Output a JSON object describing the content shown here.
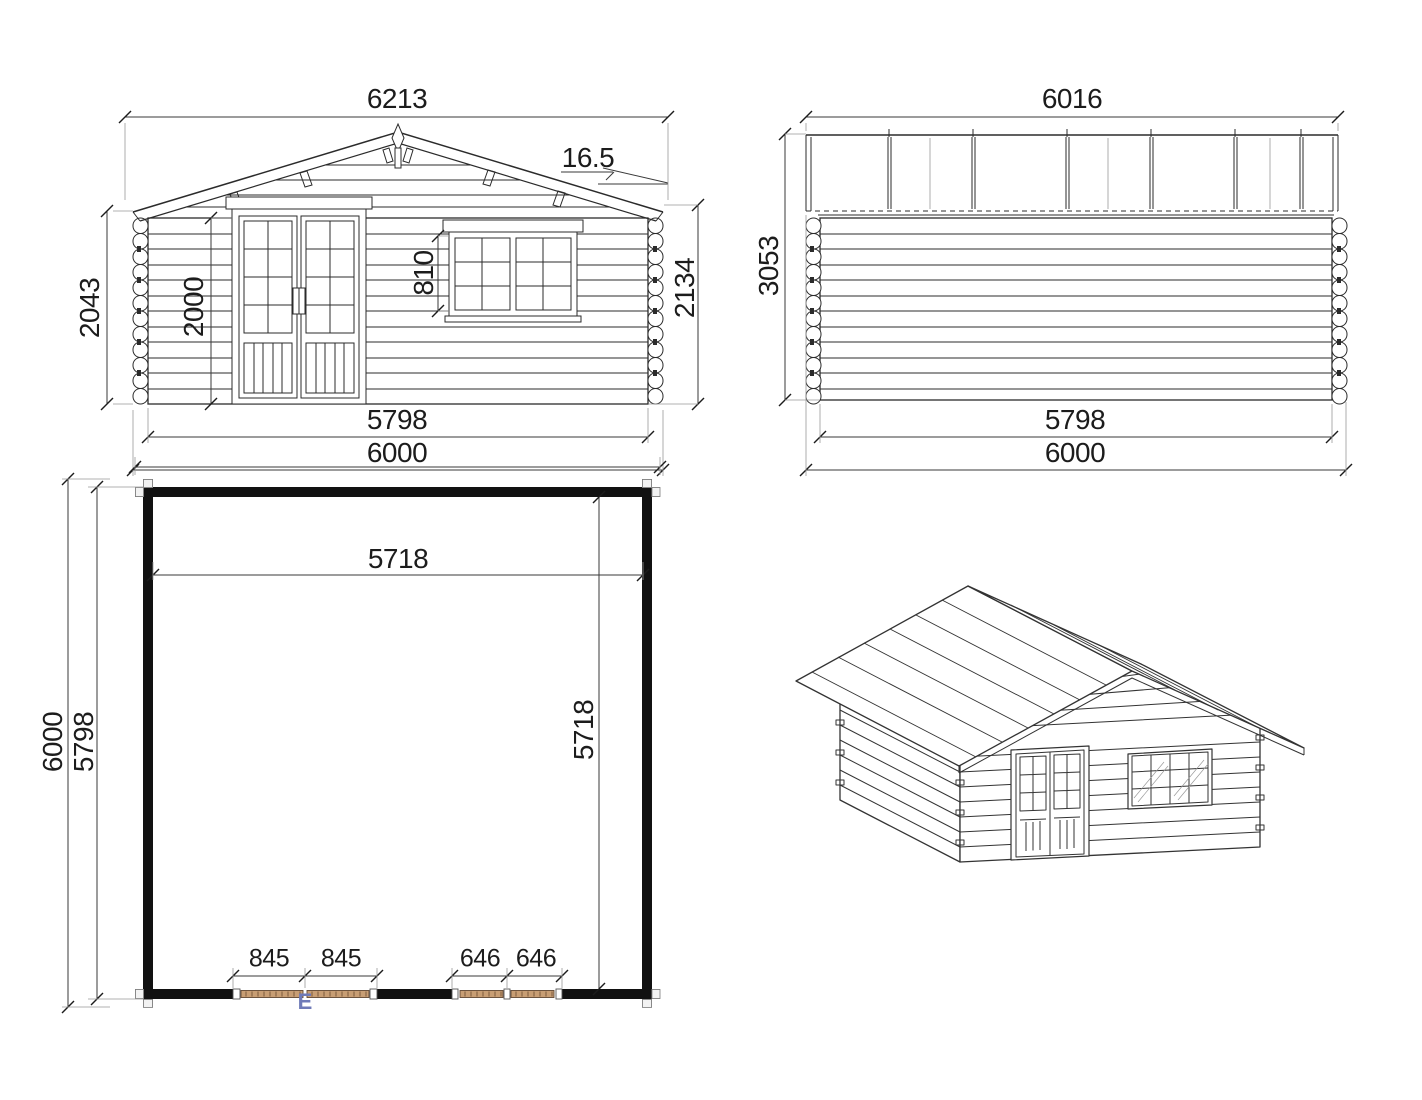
{
  "sheet": {
    "background": "#ffffff"
  },
  "views": {
    "front_elevation": {
      "label": "front-elevation",
      "dims": {
        "roof_overall_width": "6213",
        "roof_pitch_deg": "16.5",
        "eave_wall_height": "2043",
        "door_height": "2000",
        "window_height": "810",
        "right_wall_height": "2134",
        "wall_length": "5798",
        "overall_width": "6000"
      }
    },
    "side_elevation": {
      "label": "side-elevation",
      "dims": {
        "roof_length": "6016",
        "ridge_height": "3053",
        "wall_length": "5798",
        "overall_length": "6000"
      }
    },
    "floor_plan": {
      "label": "floor-plan",
      "dims": {
        "overall_width": "6000",
        "inner_width": "5718",
        "overall_depth": "6000",
        "wall_outer_depth": "5798",
        "inner_depth": "5718",
        "door_leaf_left": "845",
        "door_leaf_right": "845",
        "window_leaf_left": "646",
        "window_leaf_right": "646"
      },
      "door_marker": "E"
    },
    "isometric_view": {
      "label": "3d-view"
    }
  },
  "colors": {
    "line": "#2b2b2b",
    "dim_line": "#3a3a3a",
    "extension_line": "#999999",
    "wood_fill": "#c89e74",
    "wood_hatch": "#6b4a2e",
    "marker_blue": "#6f7ab8"
  }
}
